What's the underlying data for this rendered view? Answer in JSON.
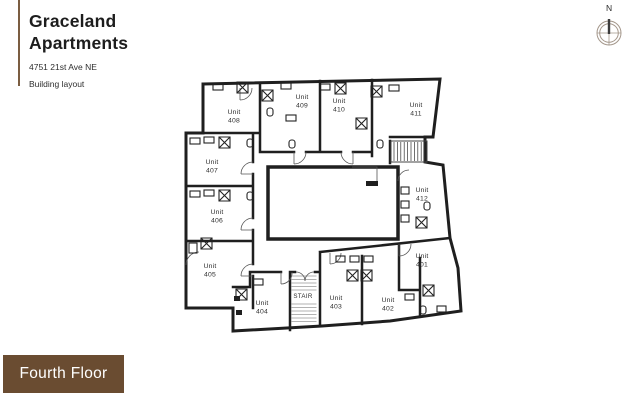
{
  "header": {
    "title_line1": "Graceland",
    "title_line2": "Apartments",
    "address": "4751 21st Ave NE",
    "subtitle": "Building layout"
  },
  "compass": {
    "north_label": "N"
  },
  "floor_badge": {
    "label": "Fourth Floor"
  },
  "colors": {
    "badge_brown": "#6a4c31",
    "accent_bar": "#7b5d41",
    "wall": "#1f1f1f",
    "compass": "#a3968a"
  },
  "plan": {
    "stair_label": "STAIR",
    "units": [
      {
        "label": "Unit",
        "number": "401"
      },
      {
        "label": "Unit",
        "number": "402"
      },
      {
        "label": "Unit",
        "number": "403"
      },
      {
        "label": "Unit",
        "number": "404"
      },
      {
        "label": "Unit",
        "number": "405"
      },
      {
        "label": "Unit",
        "number": "406"
      },
      {
        "label": "Unit",
        "number": "407"
      },
      {
        "label": "Unit",
        "number": "408"
      },
      {
        "label": "Unit",
        "number": "409"
      },
      {
        "label": "Unit",
        "number": "410"
      },
      {
        "label": "Unit",
        "number": "411"
      },
      {
        "label": "Unit",
        "number": "412"
      }
    ]
  }
}
